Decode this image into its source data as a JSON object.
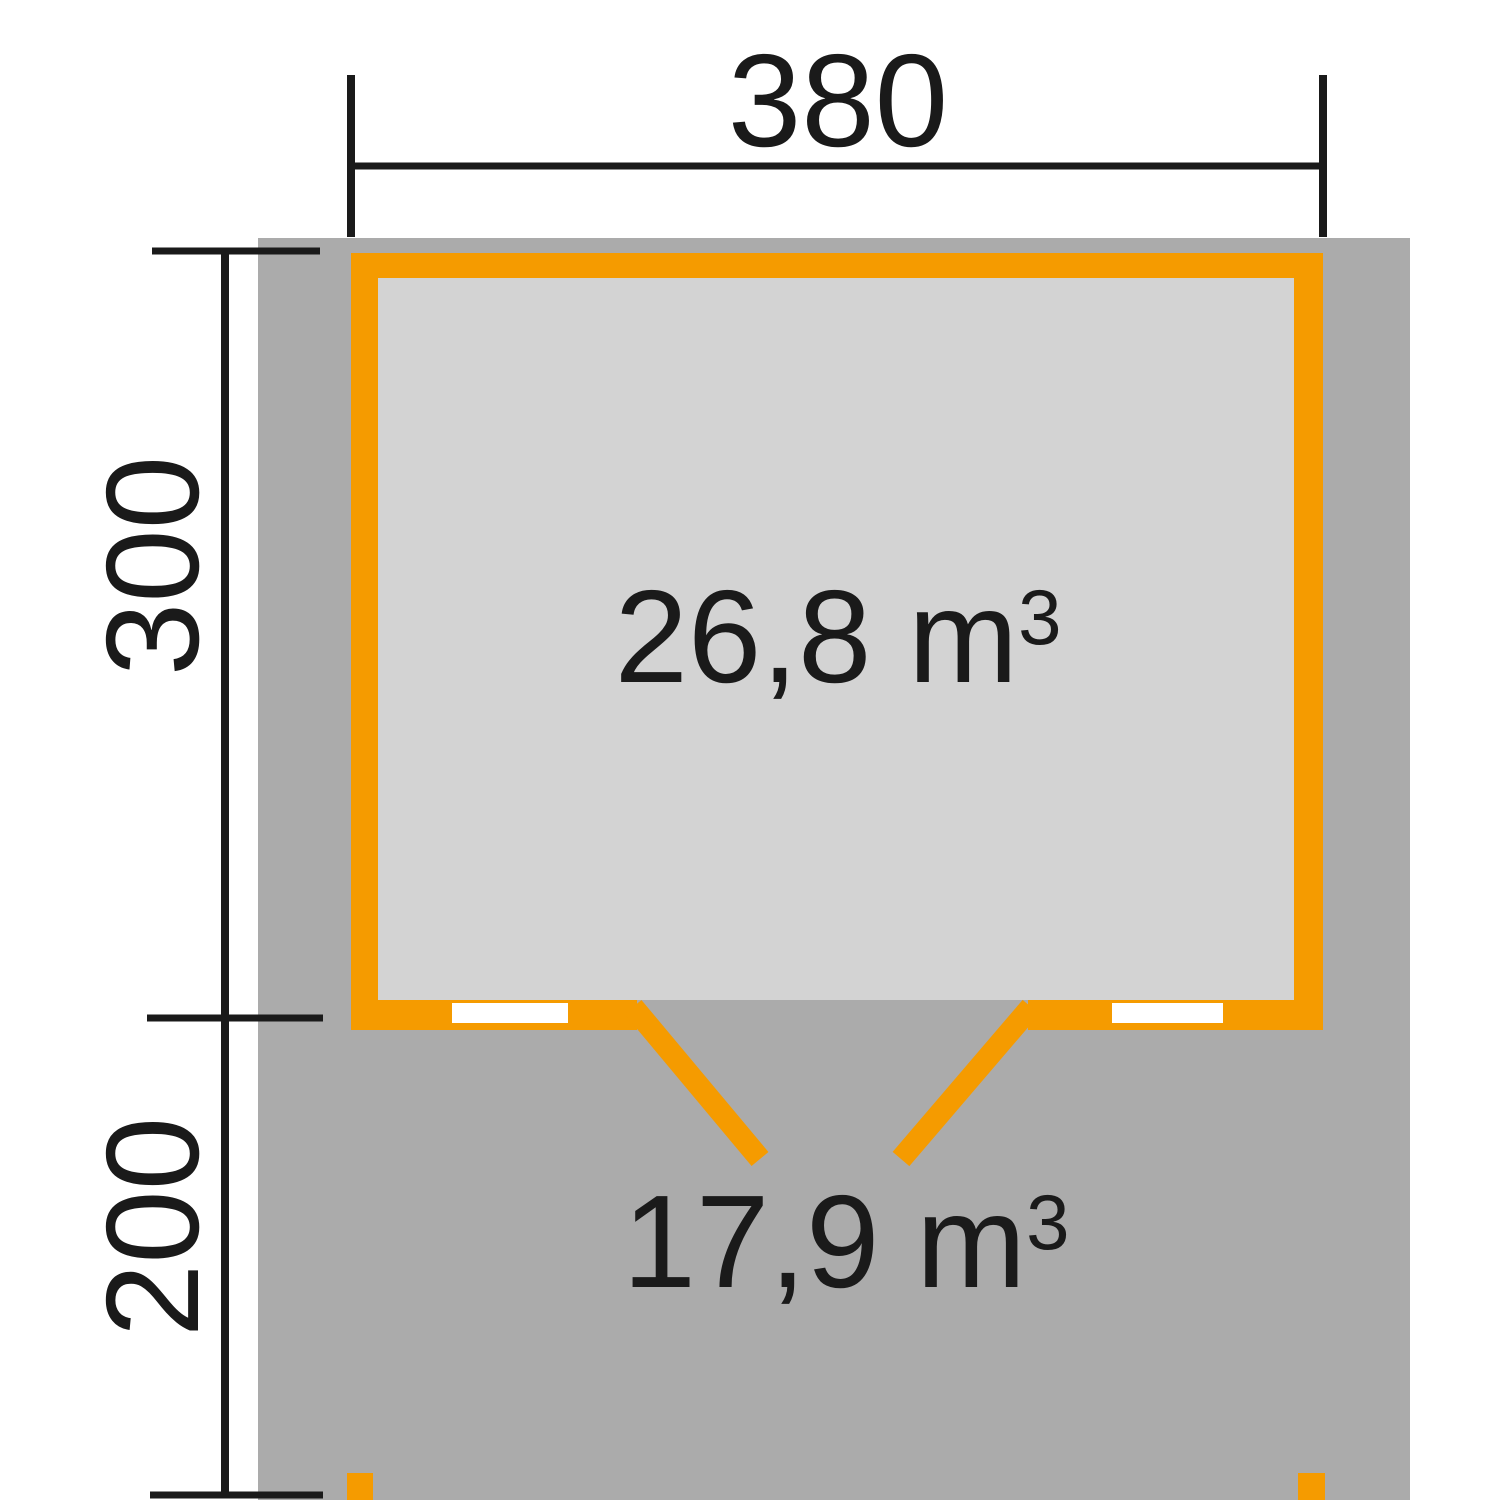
{
  "colors": {
    "accent-orange": "#F59B00",
    "terrace-gray": "#ABABAB",
    "interior-gray": "#D3D3D3",
    "line-black": "#1A1A1A",
    "window-white": "#FFFFFF",
    "page-white": "#FFFFFF"
  },
  "floor_plan": {
    "width_dimension_label": "380",
    "house_depth_dimension_label": "300",
    "terrace_depth_dimension_label": "200",
    "house_volume": {
      "text": "26,8 m",
      "exponent": "3"
    },
    "terrace_volume": {
      "text": "17,9 m",
      "exponent": "3"
    }
  }
}
